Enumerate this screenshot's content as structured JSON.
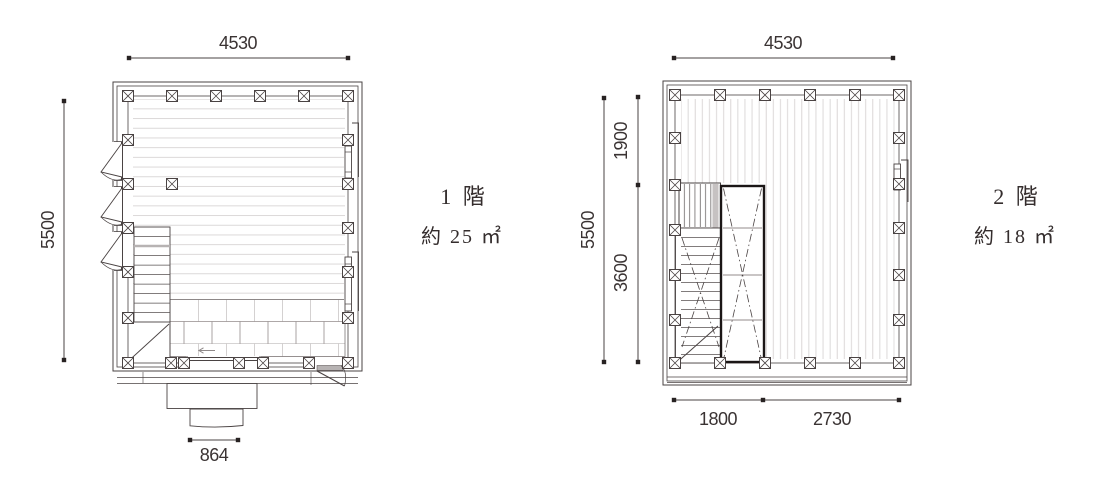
{
  "drawing": {
    "floor1": {
      "title": "1 階",
      "area": "約 25 ㎡",
      "dim_width": "4530",
      "dim_height": "5500",
      "dim_entrance": "864"
    },
    "floor2": {
      "title": "2 階",
      "area": "約 18 ㎡",
      "dim_width": "4530",
      "dim_height": "5500",
      "dim_upper": "1900",
      "dim_lower": "3600",
      "dim_bottom_left": "1800",
      "dim_bottom_right": "2730"
    }
  }
}
